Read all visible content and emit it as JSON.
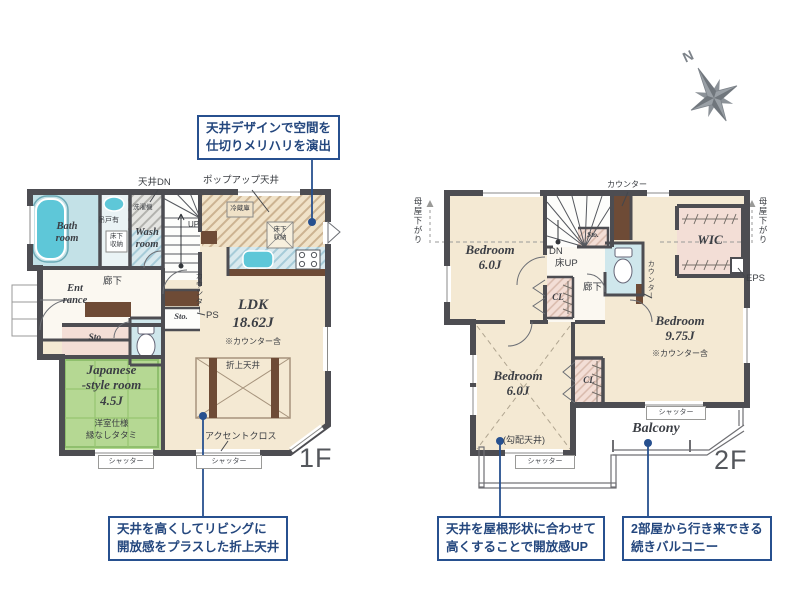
{
  "compass": {
    "north": "N"
  },
  "colors": {
    "accent_navy": "#27508f",
    "wall": "#4d4d52",
    "room_cream": "#f4e9d3",
    "bath_blue": "#c3e1e7",
    "tatami_green": "#b5d893",
    "closet_pink": "#f3ded6",
    "counter_brown": "#6e4b36",
    "fixture_cyan": "#5ec7d8"
  },
  "floor1": {
    "floor_label": "1F",
    "callout_top": "天井デザインで空間を\n仕切りメリハリを演出",
    "callout_bottom": "天井を高くしてリビングに\n開放感をプラスした折上天井",
    "labels": {
      "ceiling_dn": "天井DN",
      "popup_ceiling": "ポップアップ天井",
      "bath_room": "Bath\nroom",
      "hanging_cabinet": "吊戸有",
      "underfloor_storage_wash": "床下\n収納",
      "washing_machine": "洗濯機",
      "wash_room": "Wash\nroom",
      "up": "UP",
      "refrigerator": "冷蔵庫",
      "underfloor_storage_kitchen": "床下\n収納",
      "entrance": "Ent\nrance",
      "hallway": "廊下",
      "counter": "カウンター",
      "ps": "PS",
      "storage_small": "Sto.",
      "storage_pink": "Sto.",
      "japanese_room": "Japanese\n-style room\n4.5J",
      "japanese_note1": "洋室仕様",
      "japanese_note2": "縁なしタタミ",
      "ldk": "LDK\n18.62J",
      "counter_note": "※カウンター含",
      "oriage_ceiling": "折上天井",
      "accent_cross": "アクセントクロス",
      "shutter_left": "シャッター",
      "shutter_right": "シャッター"
    }
  },
  "floor2": {
    "floor_label": "2F",
    "callout_left": "天井を屋根形状に合わせて\n高くすることで開放感UP",
    "callout_right": "2部屋から行き来できる\n続きバルコニー",
    "labels": {
      "moya_left": "母屋下がり",
      "moya_right": "母屋下がり",
      "counter_top": "カウンター",
      "bedroom1": "Bedroom\n6.0J",
      "dn": "DN",
      "floor_up": "床UP",
      "storage": "Sto.",
      "hallway": "廊下",
      "closet1": "CL",
      "wic": "WIC",
      "eps": "EPS",
      "counter_right": "カウンター",
      "bedroom2": "Bedroom\n9.75J",
      "counter_note": "※カウンター含",
      "bedroom3": "Bedroom\n6.0J",
      "closet2": "CL",
      "sloped_ceiling": "(勾配天井)",
      "balcony": "Balcony",
      "shutter_bottom": "シャッター",
      "shutter_right": "シャッター"
    }
  }
}
